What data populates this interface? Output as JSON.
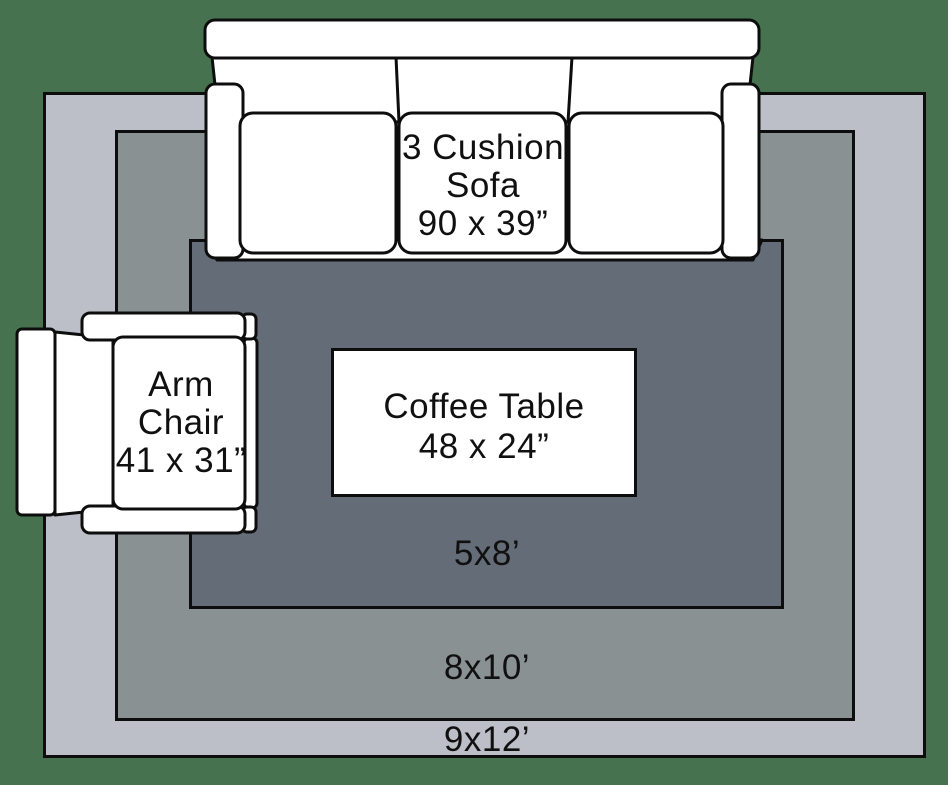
{
  "scene": {
    "background_color": "#47724F",
    "outline_color": "#0d0d0d",
    "furniture_fill": "#ffffff"
  },
  "rugs": [
    {
      "id": "rug-9x12",
      "label": "9x12’",
      "fill": "#BCBFC7"
    },
    {
      "id": "rug-8x10",
      "label": "8x10’",
      "fill": "#8A9193"
    },
    {
      "id": "rug-5x8",
      "label": "5x8’",
      "fill": "#646C77"
    }
  ],
  "furniture": {
    "sofa": {
      "lines": [
        "3 Cushion",
        "Sofa",
        "90 x 39”"
      ]
    },
    "arm_chair": {
      "lines": [
        "Arm",
        "Chair",
        "41 x 31”"
      ]
    },
    "coffee_table": {
      "lines": [
        "Coffee Table",
        "48 x 24”"
      ]
    }
  }
}
